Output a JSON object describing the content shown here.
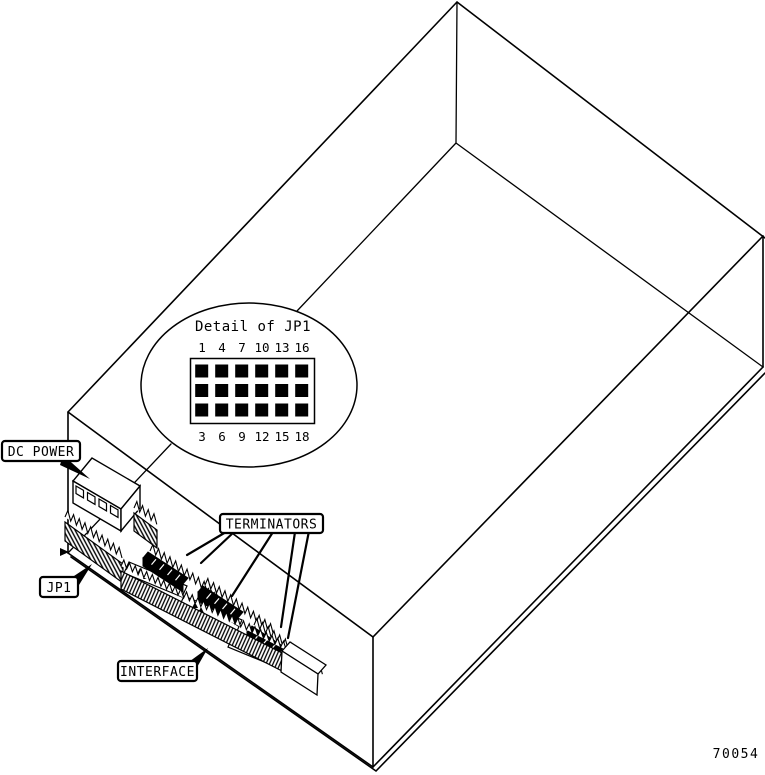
{
  "figure": {
    "number": "70054"
  },
  "callouts": {
    "dc_power": "DC POWER",
    "jp1": "JP1",
    "terminators": "TERMINATORS",
    "interface": "INTERFACE"
  },
  "detail": {
    "title": "Detail of JP1",
    "pins_top": [
      "1",
      "4",
      "7",
      "10",
      "13",
      "16"
    ],
    "pins_bottom": [
      "3",
      "6",
      "9",
      "12",
      "15",
      "18"
    ]
  },
  "colors": {
    "ink": "#000000",
    "paper": "#ffffff"
  }
}
